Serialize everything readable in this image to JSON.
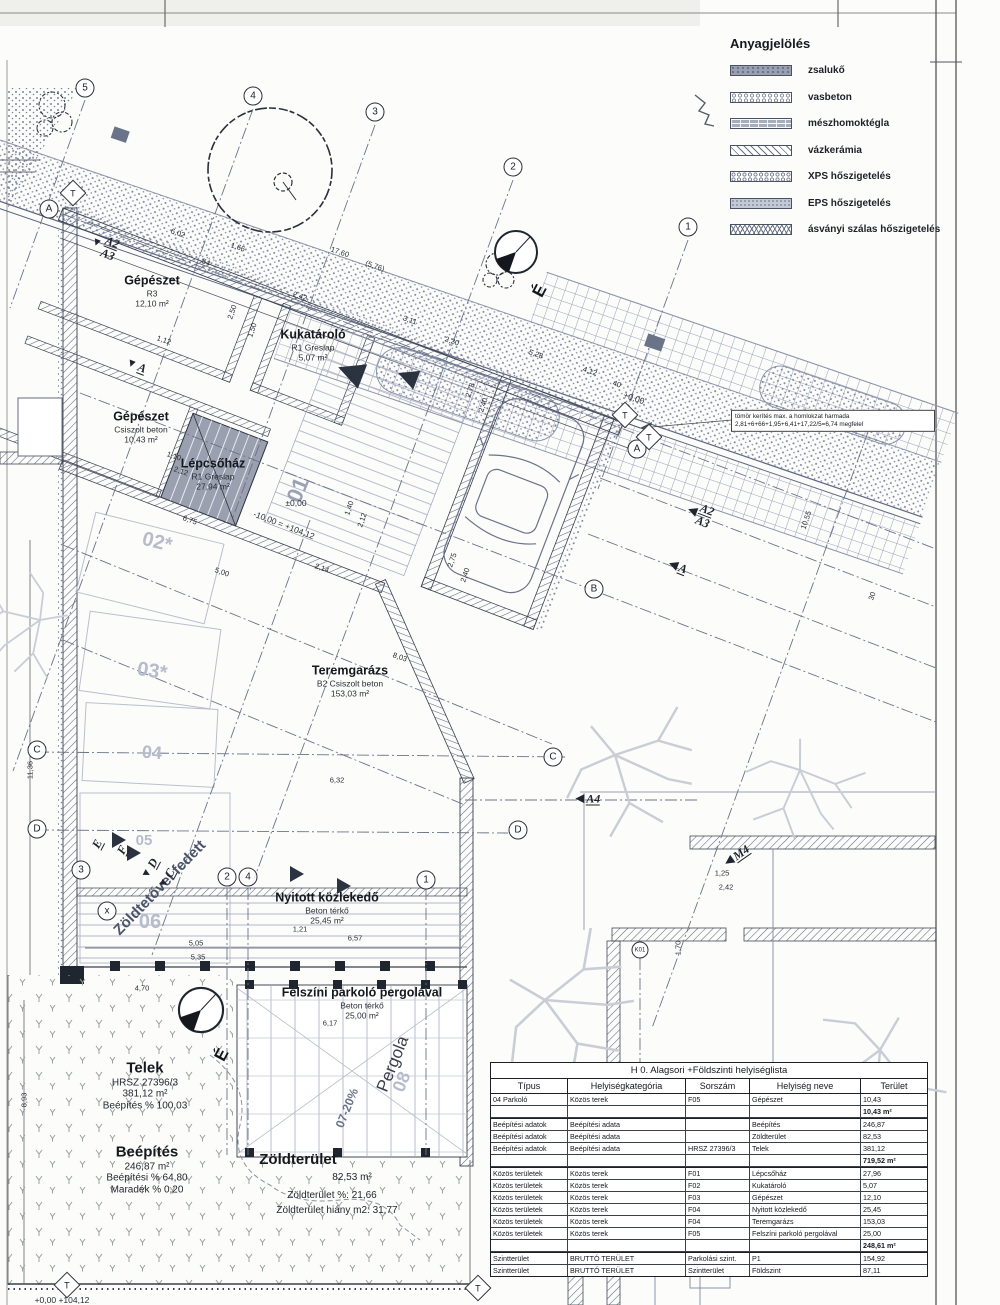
{
  "legend": {
    "title": "Anyagjelölés",
    "items": [
      {
        "label": "zsalukő",
        "pattern": "sw-zsaluko"
      },
      {
        "label": "vasbeton",
        "pattern": "sw-vasbeton"
      },
      {
        "label": "mészhomoktégla",
        "pattern": "sw-meszhomok"
      },
      {
        "label": "vázkerámia",
        "pattern": "sw-vazker"
      },
      {
        "label": "XPS hőszigetelés",
        "pattern": "sw-xps"
      },
      {
        "label": "EPS hőszigetelés",
        "pattern": "sw-eps"
      },
      {
        "label": "ásványi szálas hőszigetelés",
        "pattern": "sw-asvanyi"
      }
    ]
  },
  "labels": [
    {
      "x": 152,
      "y": 291,
      "t1": "Gépészet",
      "t2": "R3",
      "t3": "12,10 m²",
      "cls": "room"
    },
    {
      "x": 313,
      "y": 345,
      "t1": "Kukatároló",
      "t2": "R1 Greslap",
      "t3": "5,07 m²",
      "cls": "room"
    },
    {
      "x": 141,
      "y": 427,
      "t1": "Gépészet",
      "t2": "Csiszolt beton",
      "t3": "10,43 m²",
      "cls": "room"
    },
    {
      "x": 213,
      "y": 474,
      "t1": "Lépcsőház",
      "t2": "R1 Greslap",
      "t3": "27,94 m²",
      "cls": "room"
    },
    {
      "x": 350,
      "y": 681,
      "t1": "Teremgarázs",
      "t2": "B2 Csiszolt beton",
      "t3": "153,03 m²",
      "cls": "room"
    },
    {
      "x": 327,
      "y": 908,
      "t1": "Nyitott közlekedő",
      "t2": "Beton térkő",
      "t3": "25,45 m²",
      "cls": "room"
    },
    {
      "x": 362,
      "y": 1003,
      "t1": "Felszíni parkoló pergolával",
      "t2": "Beton térkő",
      "t3": "25,00 m²",
      "cls": "room"
    },
    {
      "x": 145,
      "y": 1086,
      "t1": "Telek",
      "t2": "HRSZ 27396/3",
      "t3": "381,12 m²",
      "t4": "Beépítés % 100,03",
      "cls": "site"
    },
    {
      "x": 147,
      "y": 1170,
      "t1": "Beépítés",
      "t2": "246,87 m²",
      "t3": "Beépítési % 64,80",
      "t4": "Maradék % 0,20",
      "cls": "site"
    },
    {
      "x": 298,
      "y": 1160,
      "t1": "Zöldterület",
      "cls": "site"
    },
    {
      "x": 352,
      "y": 1178,
      "t1": "82,53 m²",
      "cls": "plain"
    },
    {
      "x": 332,
      "y": 1196,
      "t1": "Zöldterület %:  21,66",
      "cls": "plain"
    },
    {
      "x": 337,
      "y": 1211,
      "t1": "Zöldterület hiány m2: 31,77",
      "cls": "plain"
    },
    {
      "x": 160,
      "y": 888,
      "t1": "Zöldtetővel fedett",
      "r": -46,
      "s": 15,
      "cls": "rot"
    },
    {
      "x": 393,
      "y": 1064,
      "t1": "Pergola",
      "r": -68,
      "s": 17,
      "cls": "rot2"
    },
    {
      "x": 347,
      "y": 1108,
      "t1": "07-20%",
      "r": -68,
      "s": 12,
      "cls": "rot3"
    },
    {
      "x": 402,
      "y": 1082,
      "t1": "08",
      "r": -68,
      "s": 18,
      "cls": "pk"
    },
    {
      "x": 157,
      "y": 543,
      "t1": "02*",
      "r": 14,
      "s": 20,
      "cls": "pk"
    },
    {
      "x": 152,
      "y": 672,
      "t1": "03*",
      "r": 9,
      "s": 20,
      "cls": "pk"
    },
    {
      "x": 152,
      "y": 753,
      "t1": "04",
      "r": 4,
      "s": 18,
      "cls": "pk"
    },
    {
      "x": 144,
      "y": 841,
      "t1": "05",
      "r": 0,
      "s": 15,
      "cls": "pk"
    },
    {
      "x": 150,
      "y": 923,
      "t1": "06",
      "r": 0,
      "s": 20,
      "cls": "pk"
    },
    {
      "x": 298,
      "y": 490,
      "t1": "01",
      "r": -68,
      "s": 22,
      "cls": "pk2"
    },
    {
      "x": 296,
      "y": 503,
      "t1": "±0,00",
      "cls": "lev"
    },
    {
      "x": 284,
      "y": 525,
      "t1": "-10,00 = +104,12",
      "r": 21,
      "cls": "lev"
    },
    {
      "x": 634,
      "y": 398,
      "t1": "+0,00",
      "r": 19,
      "cls": "lev"
    },
    {
      "x": 62,
      "y": 1300,
      "t1": "+0,00  +104,12",
      "cls": "lev"
    },
    {
      "x": 540,
      "y": 291,
      "t1": "É",
      "r": -62,
      "cls": "north"
    },
    {
      "x": 222,
      "y": 1055,
      "t1": "É",
      "r": -62,
      "cls": "north"
    },
    {
      "x": 833,
      "y": 421,
      "t1": "tömör kerítés max. a homlokzat harmada",
      "t2": "2,81+6+66+1,95+6,41+17,22/5=6,74 megfelel",
      "w": 196,
      "cls": "box"
    }
  ],
  "dims": [
    {
      "x": 178,
      "y": 233,
      "r": 19,
      "t": "6,02"
    },
    {
      "x": 238,
      "y": 247,
      "r": 19,
      "t": "1,66"
    },
    {
      "x": 206,
      "y": 262,
      "r": 19,
      "t": "54"
    },
    {
      "x": 340,
      "y": 252,
      "r": 19,
      "t": "17,60"
    },
    {
      "x": 375,
      "y": 266,
      "r": 19,
      "t": "(5,76)"
    },
    {
      "x": 300,
      "y": 296,
      "r": 19,
      "t": "2,42"
    },
    {
      "x": 410,
      "y": 320,
      "r": 19,
      "t": "3,11"
    },
    {
      "x": 452,
      "y": 341,
      "r": 19,
      "t": "2,20"
    },
    {
      "x": 536,
      "y": 354,
      "r": 19,
      "t": "5,28"
    },
    {
      "x": 590,
      "y": 371,
      "r": 19,
      "t": "4,12"
    },
    {
      "x": 617,
      "y": 384,
      "r": 19,
      "t": "40"
    },
    {
      "x": 252,
      "y": 330,
      "r": -71,
      "t": "1,50"
    },
    {
      "x": 232,
      "y": 312,
      "r": -71,
      "t": "2,50"
    },
    {
      "x": 470,
      "y": 390,
      "r": -71,
      "t": "2,78"
    },
    {
      "x": 483,
      "y": 405,
      "r": -71,
      "t": "2,40"
    },
    {
      "x": 164,
      "y": 340,
      "r": 19,
      "t": "1,12"
    },
    {
      "x": 174,
      "y": 456,
      "r": 19,
      "t": "1,10"
    },
    {
      "x": 181,
      "y": 471,
      "r": 19,
      "t": "2,12"
    },
    {
      "x": 349,
      "y": 508,
      "r": -71,
      "t": "1,40"
    },
    {
      "x": 362,
      "y": 520,
      "r": -71,
      "t": "2,12"
    },
    {
      "x": 190,
      "y": 520,
      "r": 19,
      "t": "6,75"
    },
    {
      "x": 222,
      "y": 572,
      "r": 19,
      "t": "5,00"
    },
    {
      "x": 322,
      "y": 568,
      "r": 19,
      "t": "2,14"
    },
    {
      "x": 452,
      "y": 560,
      "r": -71,
      "t": "2,75"
    },
    {
      "x": 465,
      "y": 575,
      "r": -71,
      "t": "2,40"
    },
    {
      "x": 400,
      "y": 657,
      "r": 19,
      "t": "8,03"
    },
    {
      "x": 337,
      "y": 780,
      "r": 0,
      "t": "6,32"
    },
    {
      "x": 300,
      "y": 929,
      "r": 0,
      "t": "1,21"
    },
    {
      "x": 355,
      "y": 938,
      "r": 0,
      "t": "6,57"
    },
    {
      "x": 196,
      "y": 943,
      "r": 0,
      "t": "5,05"
    },
    {
      "x": 198,
      "y": 957,
      "r": 0,
      "t": "5,35"
    },
    {
      "x": 330,
      "y": 1023,
      "r": 0,
      "t": "6,17"
    },
    {
      "x": 142,
      "y": 988,
      "r": 0,
      "t": "4,70"
    },
    {
      "x": 722,
      "y": 873,
      "r": 0,
      "t": "1,25"
    },
    {
      "x": 726,
      "y": 887,
      "r": 0,
      "t": "2,42"
    },
    {
      "x": 678,
      "y": 948,
      "r": -90,
      "t": "1,70"
    },
    {
      "x": 30,
      "y": 770,
      "r": -90,
      "t": "11,36"
    },
    {
      "x": 24,
      "y": 1100,
      "r": -90,
      "t": "8,93"
    },
    {
      "x": 806,
      "y": 520,
      "r": -71,
      "t": "10,55"
    },
    {
      "x": 872,
      "y": 596,
      "r": -71,
      "t": "30"
    }
  ],
  "bubbles": [
    {
      "x": 85,
      "y": 88,
      "t": "5"
    },
    {
      "x": 253,
      "y": 96,
      "t": "4"
    },
    {
      "x": 375,
      "y": 112,
      "t": "3"
    },
    {
      "x": 513,
      "y": 167,
      "t": "2"
    },
    {
      "x": 688,
      "y": 227,
      "t": "1"
    },
    {
      "x": 49,
      "y": 209,
      "t": "A"
    },
    {
      "x": 637,
      "y": 449,
      "t": "A"
    },
    {
      "x": 594,
      "y": 589,
      "t": "B"
    },
    {
      "x": 37,
      "y": 750,
      "t": "C"
    },
    {
      "x": 553,
      "y": 757,
      "t": "C"
    },
    {
      "x": 37,
      "y": 829,
      "t": "D"
    },
    {
      "x": 518,
      "y": 830,
      "t": "D"
    },
    {
      "x": 81,
      "y": 870,
      "t": "3"
    },
    {
      "x": 107,
      "y": 911,
      "t": "x"
    },
    {
      "x": 227,
      "y": 877,
      "t": "2"
    },
    {
      "x": 248,
      "y": 877,
      "t": "4"
    },
    {
      "x": 426,
      "y": 880,
      "t": "1"
    },
    {
      "x": 640,
      "y": 950,
      "t": "K01",
      "cls": "small"
    }
  ],
  "sections": [
    {
      "x": 104,
      "y": 246,
      "r": 21,
      "g": "▼",
      "t": "A2",
      "t2": "A3"
    },
    {
      "x": 136,
      "y": 366,
      "r": 21,
      "g": "▼",
      "t": "A"
    },
    {
      "x": 700,
      "y": 514,
      "r": 21,
      "g": "◀",
      "t": "A2",
      "t2": "A3"
    },
    {
      "x": 678,
      "y": 567,
      "r": 21,
      "g": "◀",
      "t": "A"
    },
    {
      "x": 588,
      "y": 799,
      "r": 0,
      "g": "◀",
      "t": "A4"
    },
    {
      "x": 737,
      "y": 856,
      "r": -35,
      "g": "◀",
      "t": "M4"
    },
    {
      "x": 97,
      "y": 845,
      "r": -62,
      "g": "",
      "t": "E"
    },
    {
      "x": 122,
      "y": 851,
      "r": -62,
      "g": "",
      "t": "F"
    },
    {
      "x": 150,
      "y": 869,
      "r": -62,
      "g": "▼",
      "t": "D"
    },
    {
      "x": 167,
      "y": 879,
      "r": -62,
      "g": "▼",
      "t": "C"
    }
  ],
  "diamonds": [
    {
      "x": 73,
      "y": 193,
      "t": "T"
    },
    {
      "x": 625,
      "y": 415,
      "t": "T"
    },
    {
      "x": 649,
      "y": 437,
      "t": "T"
    },
    {
      "x": 67,
      "y": 1285,
      "t": "T"
    },
    {
      "x": 478,
      "y": 1288,
      "t": "T"
    }
  ],
  "table": {
    "title": "H 0. Alagsori +Földszinti helyiséglista",
    "columns": [
      {
        "t": "Típus",
        "cls": "c1"
      },
      {
        "t": "Helyiségkategória",
        "cls": "c2"
      },
      {
        "t": "Sorszám",
        "cls": "c3"
      },
      {
        "t": "Helyiség neve",
        "cls": "c4"
      },
      {
        "t": "Terület",
        "cls": "c5"
      }
    ],
    "rows": [
      {
        "c1": "04 Parkoló",
        "c2": "Közös terek",
        "c3": "F05",
        "c4": "Gépészet",
        "c5": "10,43"
      },
      {
        "c5": "10,43 m²",
        "cls": "sub"
      },
      {
        "c1": "Beépítési adatok",
        "c2": "Beépítési adata",
        "c4": "Beépítés",
        "c5": "246,87",
        "cls": "hv"
      },
      {
        "c1": "Beépítési adatok",
        "c2": "Beépítési adata",
        "c4": "Zöldterület",
        "c5": "82,53"
      },
      {
        "c1": "Beépítési adatok",
        "c2": "Beépítési adata",
        "c3": "HRSZ 27396/3",
        "c4": "Telek",
        "c5": "381,12"
      },
      {
        "c5": "719,52 m²",
        "cls": "sub"
      },
      {
        "c1": "Közös területek",
        "c2": "Közös terek",
        "c3": "F01",
        "c4": "Lépcsőház",
        "c5": "27,96",
        "cls": "hv"
      },
      {
        "c1": "Közös területek",
        "c2": "Közös terek",
        "c3": "F02",
        "c4": "Kukatároló",
        "c5": "5,07"
      },
      {
        "c1": "Közös területek",
        "c2": "Közös terek",
        "c3": "F03",
        "c4": "Gépészet",
        "c5": "12,10"
      },
      {
        "c1": "Közös területek",
        "c2": "Közös terek",
        "c3": "F04",
        "c4": "Nyitott közlekedő",
        "c5": "25,45"
      },
      {
        "c1": "Közös területek",
        "c2": "Közös terek",
        "c3": "F04",
        "c4": "Teremgarázs",
        "c5": "153,03"
      },
      {
        "c1": "Közös területek",
        "c2": "Közös terek",
        "c3": "F05",
        "c4": "Felszíni parkoló pergolával",
        "c5": "25,00"
      },
      {
        "c5": "248,61 m²",
        "cls": "sub"
      },
      {
        "c1": "Szintterület",
        "c2": "BRUTTÓ TERÜLET",
        "c3": "Parkolási szint.",
        "c4": "P1",
        "c5": "154,92",
        "cls": "hv"
      },
      {
        "c1": "Szintterület",
        "c2": "BRUTTÓ TERÜLET",
        "c3": "Szintterület",
        "c4": "Földszint",
        "c5": "87,11"
      }
    ]
  }
}
